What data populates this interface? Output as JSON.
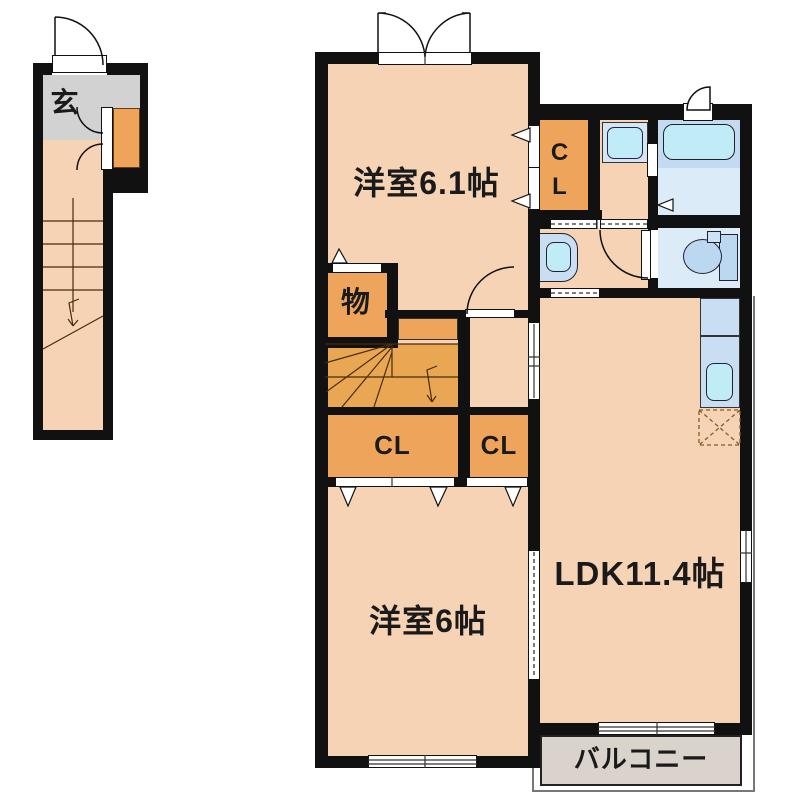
{
  "floor_plan": {
    "labels": {
      "genkan": "玄",
      "bedroom1": "洋室6.1帖",
      "closet_main": "CL",
      "storage": "物",
      "closet_large": "CL",
      "closet_small": "CL",
      "bedroom2": "洋室6帖",
      "ldk": "LDK11.4帖",
      "balcony": "バルコニー"
    },
    "colors": {
      "wall": "#111111",
      "floor_peach": "#f5d3b4",
      "closet_orange": "#efa45c",
      "stair_orange": "#e9a653",
      "entry_tile_gray": "#d2d2d2",
      "balcony_gray": "#d9d3cb",
      "wet_area_light": "#dcebf8",
      "wet_area_mid": "#c3daf2",
      "fixture_blue": "#bcd7f0",
      "counter_blue": "#c9def3",
      "basin_cyan": "#bfecf7"
    }
  }
}
